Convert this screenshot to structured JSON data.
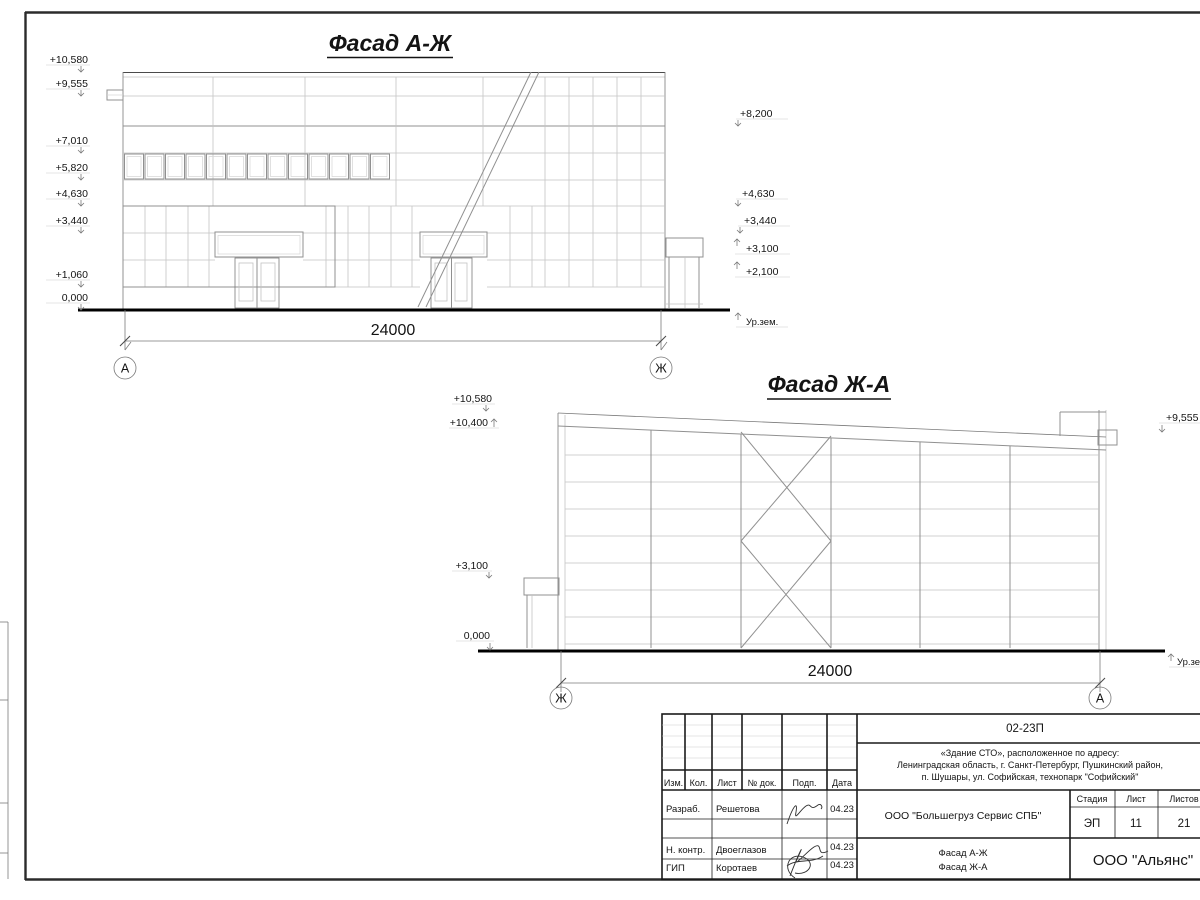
{
  "facade1": {
    "title": "Фасад А-Ж",
    "dimension": "24000",
    "axis_left": "А",
    "axis_right": "Ж",
    "marks_left": [
      "+10,580",
      "+9,555",
      "+7,010",
      "+5,820",
      "+4,630",
      "+3,440",
      "+1,060",
      "0,000"
    ],
    "marks_right": [
      "+8,200",
      "+4,630",
      "+3,440",
      "+3,100",
      "+2,100"
    ],
    "ground_label": "Ур.зем."
  },
  "facade2": {
    "title": "Фасад Ж-А",
    "dimension": "24000",
    "axis_left": "Ж",
    "axis_right": "А",
    "marks_left": [
      "+10,580",
      "+10,400",
      "+3,100",
      "0,000"
    ],
    "marks_right": [
      "+9,555"
    ],
    "ground_label": "Ур.зем."
  },
  "stamp": {
    "doc_number": "02-23П",
    "address_line1": "«Здание СТО», расположенное по адресу:",
    "address_line2": "Ленинградская область, г. Санкт-Петербург, Пушкинский район,",
    "address_line3": "п. Шушары, ул. Софийская, технопарк \"Софийский\"",
    "header": {
      "izm": "Изм.",
      "kol": "Кол.",
      "list": "Лист",
      "doc": "№ док.",
      "podp": "Подп.",
      "data": "Дата"
    },
    "rows": [
      {
        "role": "Разраб.",
        "name": "Решетова",
        "date": "04.23"
      },
      {
        "role": "Н. контр.",
        "name": "Двоеглазов",
        "date": "04.23"
      },
      {
        "role": "ГИП",
        "name": "Коротаев",
        "date": "04.23"
      }
    ],
    "company": "ООО \"Большегруз Сервис СПБ\"",
    "stage_header": {
      "stage": "Стадия",
      "sheet": "Лист",
      "sheets": "Листов"
    },
    "stage_values": {
      "stage": "ЭП",
      "sheet": "11",
      "sheets": "21"
    },
    "sheet_titles": {
      "line1": "Фасад А-Ж",
      "line2": "Фасад Ж-А"
    },
    "org": "ООО \"Альянс\""
  }
}
